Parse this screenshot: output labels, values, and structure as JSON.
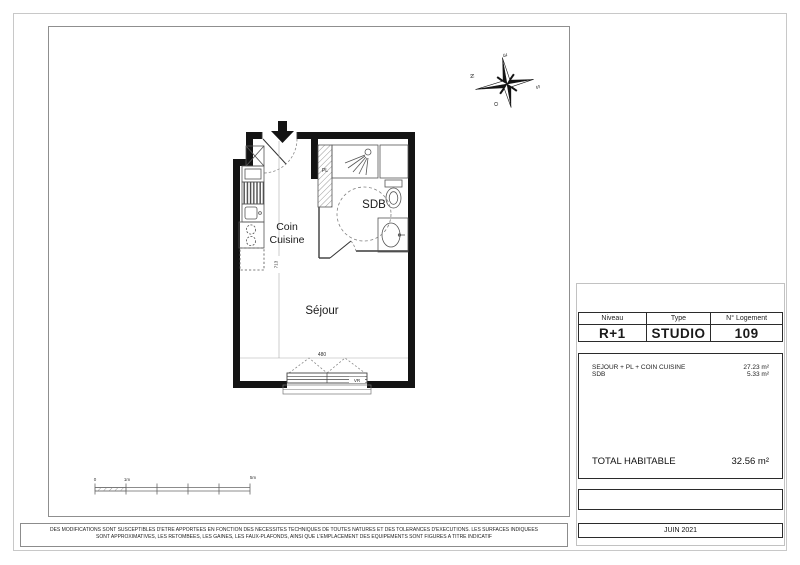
{
  "title_block": {
    "headers": [
      "Niveau",
      "Type",
      "N° Logement"
    ],
    "values": [
      "R+1",
      "STUDIO",
      "109"
    ]
  },
  "areas": {
    "rows": [
      {
        "label": "SEJOUR + PL + COIN CUISINE",
        "value": "27.23 m²"
      },
      {
        "label": "SDB",
        "value": "5.33 m²"
      }
    ],
    "total_label": "TOTAL HABITABLE",
    "total_value": "32.56 m²"
  },
  "date_box": "JUIN 2021",
  "disclaimer": {
    "line1": "DES MODIFICATIONS SONT SUSCEPTIBLES D'ETRE APPORTEES EN FONCTION DES NECESSITES TECHNIQUES DE TOUTES NATURES ET DES TOLERANCES D'EXECUTIONS. LES SURFACES INDIQUEES",
    "line2": "SONT APPROXIMATIVES, LES RETOMBEES, LES GAINES, LES FAUX-PLAFONDS, AINSI QUE L'EMPLACEMENT DES EQUIPEMENTS SONT FIGURES A TITRE INDICATIF"
  },
  "plan": {
    "room_sejour": "Séjour",
    "room_sdb": "SDB",
    "room_cuisine_line1": "Coin",
    "room_cuisine_line2": "Cuisine",
    "closet_label": "PL",
    "shutter_label": "VR",
    "dim_width": "480",
    "dim_height": "713"
  },
  "compass": {
    "north": "N",
    "east": "E",
    "south": "S",
    "west": "O"
  },
  "scale_bar": {
    "start": "0",
    "one": "1m",
    "five": "5m"
  },
  "colors": {
    "wall": "#141414",
    "table_border": "#2b2b2b"
  }
}
